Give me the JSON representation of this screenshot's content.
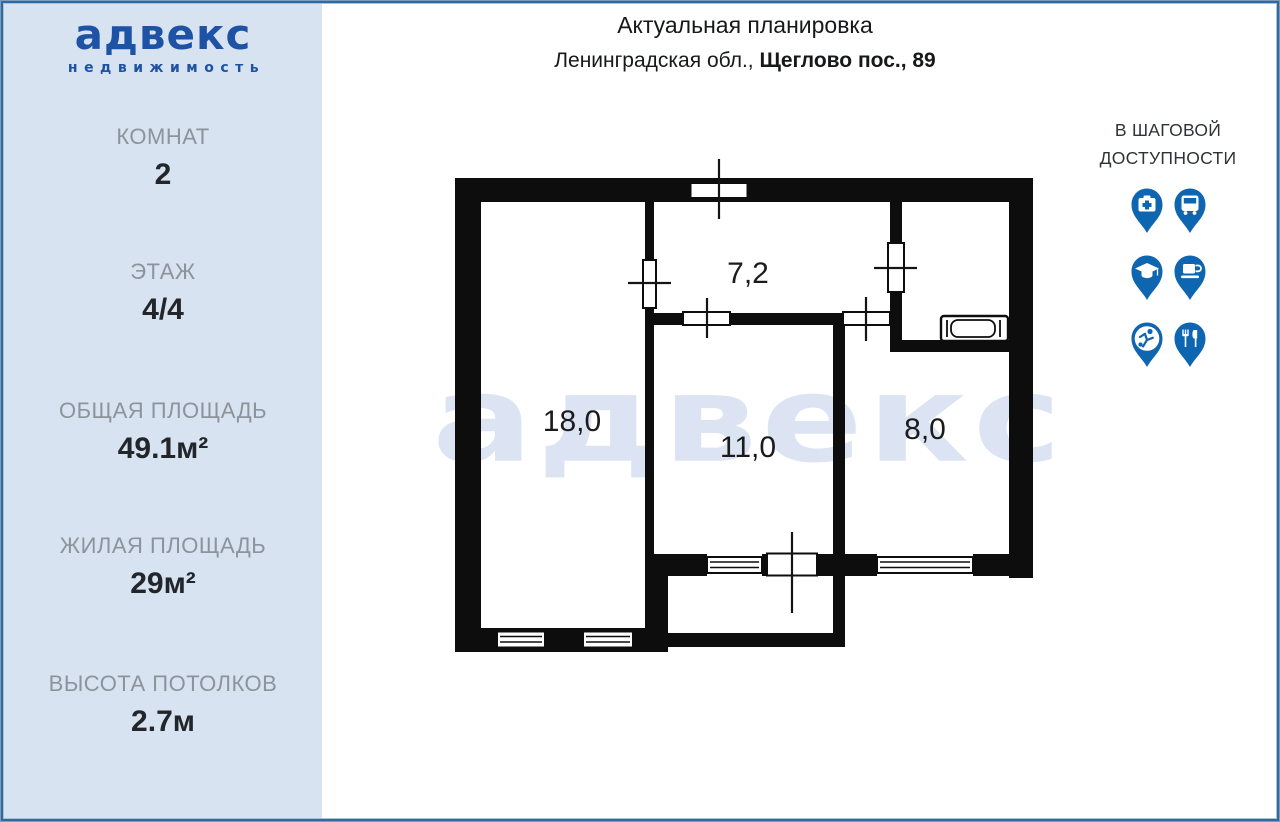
{
  "logo": {
    "brand": "адвекс",
    "tagline": "недвижимость"
  },
  "sidebar": {
    "stats": [
      {
        "label": "КОМНАТ",
        "value": "2"
      },
      {
        "label": "ЭТАЖ",
        "value": "4/4"
      },
      {
        "label": "ОБЩАЯ ПЛОЩАДЬ",
        "value": "49.1м²"
      },
      {
        "label": "ЖИЛАЯ ПЛОЩАДЬ",
        "value": "29м²"
      },
      {
        "label": "ВЫСОТА ПОТОЛКОВ",
        "value": "2.7м"
      }
    ]
  },
  "header": {
    "title": "Актуальная планировка",
    "address_regular": "Ленинградская обл., ",
    "address_bold": "Щеглово пос., 89"
  },
  "nearby": {
    "heading_line1": "В ШАГОВОЙ",
    "heading_line2": "ДОСТУПНОСТИ",
    "icons": [
      "medicine-pin",
      "bus-pin",
      "education-pin",
      "cafe-pin",
      "sport-pin",
      "restaurant-pin"
    ]
  },
  "plan": {
    "watermark": "адвекс",
    "rooms": [
      {
        "name": "hallway",
        "area": "7,2"
      },
      {
        "name": "living-room",
        "area": "18,0"
      },
      {
        "name": "bedroom",
        "area": "11,0"
      },
      {
        "name": "kitchen",
        "area": "8,0"
      }
    ]
  },
  "colors": {
    "accent_blue": "#1e52a5",
    "pin_blue": "#0f66b0",
    "sidebar_bg": "#d7e3f0",
    "watermark": "#dce4f3",
    "wall_black": "#0d0d0d"
  }
}
